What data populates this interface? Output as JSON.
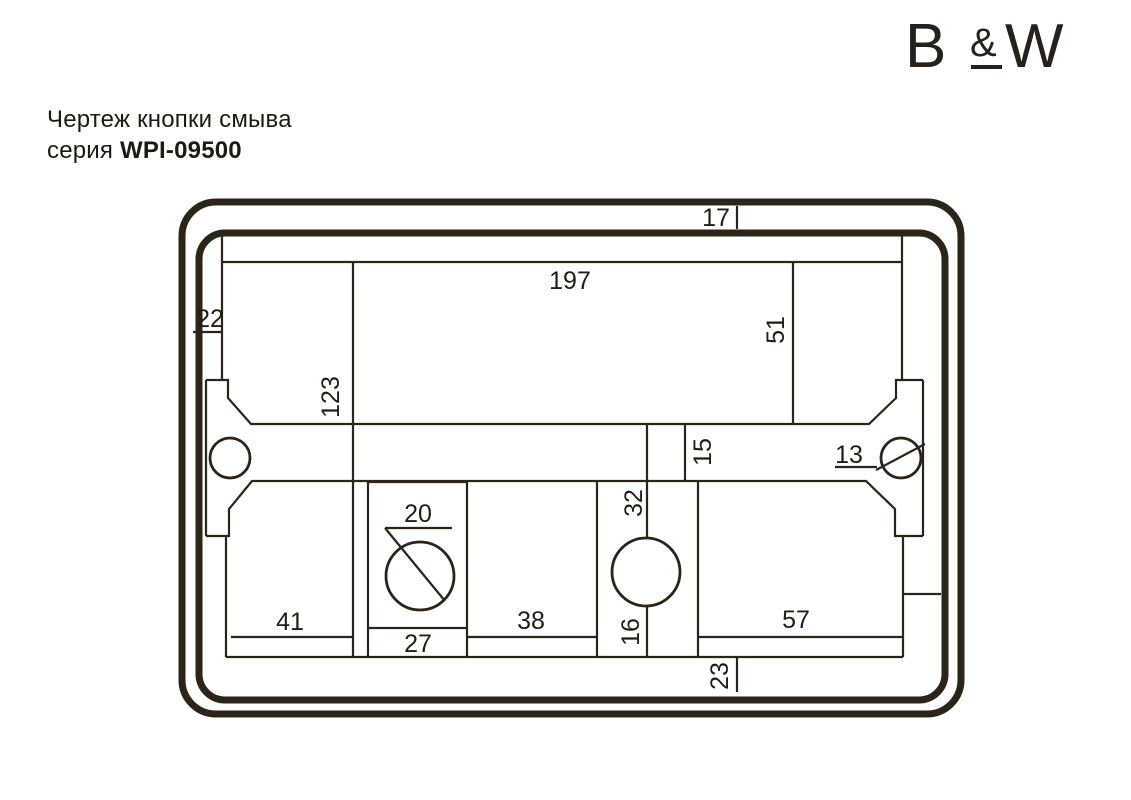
{
  "header": {
    "title_line1": "Чертеж кнопки смыва",
    "series_prefix": "серия",
    "series_code": "WPI-09500",
    "logo": {
      "b": "B",
      "amp": "&",
      "w": "W"
    }
  },
  "drawing": {
    "type": "technical-dimension-drawing",
    "colors": {
      "ink": "#2b2418",
      "text": "#211c15",
      "background": "#ffffff"
    },
    "dimensions": {
      "d197": "197",
      "d17": "17",
      "d22": "22",
      "d51": "51",
      "d123": "123",
      "d15": "15",
      "d13": "13",
      "d32": "32",
      "d20": "20",
      "d41": "41",
      "d27": "27",
      "d38": "38",
      "d16": "16",
      "d57": "57",
      "d23": "23"
    }
  }
}
